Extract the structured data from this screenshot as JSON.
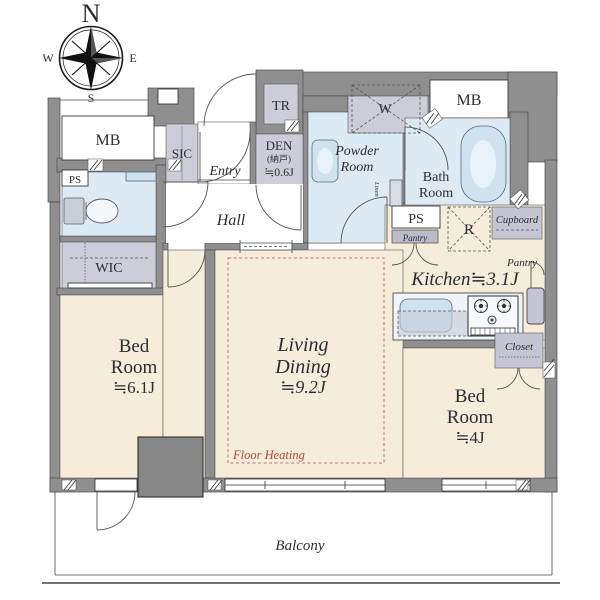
{
  "compass": {
    "n": "N",
    "e": "E",
    "s": "S",
    "w": "W"
  },
  "rooms": {
    "bedroom1": {
      "lines": [
        "Bed",
        "Room",
        "≒6.1J"
      ]
    },
    "living": {
      "lines": [
        "Living",
        "Dining",
        "≒9.2J"
      ]
    },
    "bedroom2": {
      "lines": [
        "Bed",
        "Room",
        "≒4J"
      ]
    },
    "kitchen": {
      "label": "Kitchen≒3.1J"
    },
    "den": {
      "lines": [
        "DEN",
        "(納戸)",
        "≒0.6J"
      ]
    },
    "powder": {
      "lines": [
        "Powder",
        "Room"
      ]
    },
    "bath": {
      "lines": [
        "Bath",
        "Room"
      ]
    },
    "hall": {
      "label": "Hall"
    },
    "entry": {
      "label": "Entry"
    },
    "balcony": {
      "label": "Balcony"
    }
  },
  "storage": {
    "wic": "WIC",
    "sic": "SIC",
    "tr": "TR",
    "closet": "Closet",
    "cupboard": "Cupboard",
    "pantry_box": "Pantry",
    "pantry_note": "Pantry",
    "linen": "Linen"
  },
  "service": {
    "mb_left": "MB",
    "mb_right": "MB",
    "ps_left": "PS",
    "ps_right": "PS",
    "washer": "W",
    "fridge": "R"
  },
  "annotations": {
    "floor_heating": "Floor Heating"
  },
  "colors": {
    "wall": "#8f8f8f",
    "room_cream": "#f5ecda",
    "wet_blue": "#ddeaf4",
    "storage_lavender": "#cdcdd9",
    "counter_blue": "#cfe2f0",
    "floor_heating_red": "#b0453f",
    "text": "#2c2c34"
  }
}
